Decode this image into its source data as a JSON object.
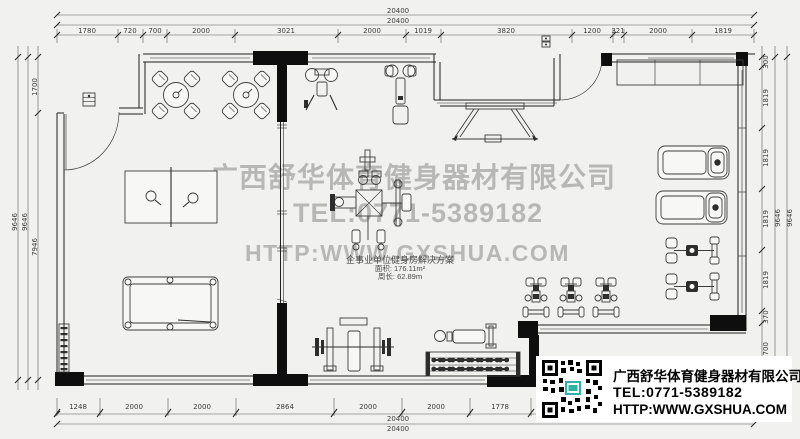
{
  "dims": {
    "top": {
      "overall": [
        "20400",
        "20400"
      ],
      "segments": [
        "1780",
        "720",
        "700",
        "2000",
        "3021",
        "2000",
        "1019",
        "3820",
        "1200",
        "321",
        "2000",
        "1819"
      ]
    },
    "bottom": {
      "overall": [
        "20400",
        "20400"
      ],
      "segments": [
        "1248",
        "2000",
        "2000",
        "2864",
        "2000",
        "2000",
        "1778"
      ]
    },
    "left": {
      "overall": [
        "9646",
        "9646"
      ],
      "segments": [
        "1700",
        "7946"
      ]
    },
    "right": {
      "overall": [
        "9646",
        "9646"
      ],
      "segments": [
        "300",
        "1819",
        "1819",
        "1819",
        "1819",
        "370",
        "1700"
      ]
    }
  },
  "plan_label": {
    "line1": "企事业单位健身房解决方案",
    "line2": "面积: 176.11m²",
    "line3": "周长: 62.89m"
  },
  "watermark": {
    "line1": "广西舒华体育健身器材有限公司",
    "line2": "TEL:0771-5389182",
    "line3": "HTTP:WWW.GXSHUA.COM",
    "color": "#b7b7b5"
  },
  "info_box": {
    "company": "广西舒华体育健身器材有限公司",
    "tel": "TEL:0771-5389182",
    "web": "HTTP:WWW.GXSHUA.COM",
    "qr": "qr-code"
  },
  "colors": {
    "background": "#f1f1ef",
    "line": "#1f1f1f",
    "wall": "#0e0e0e",
    "watermark": "#b7b7b5"
  }
}
